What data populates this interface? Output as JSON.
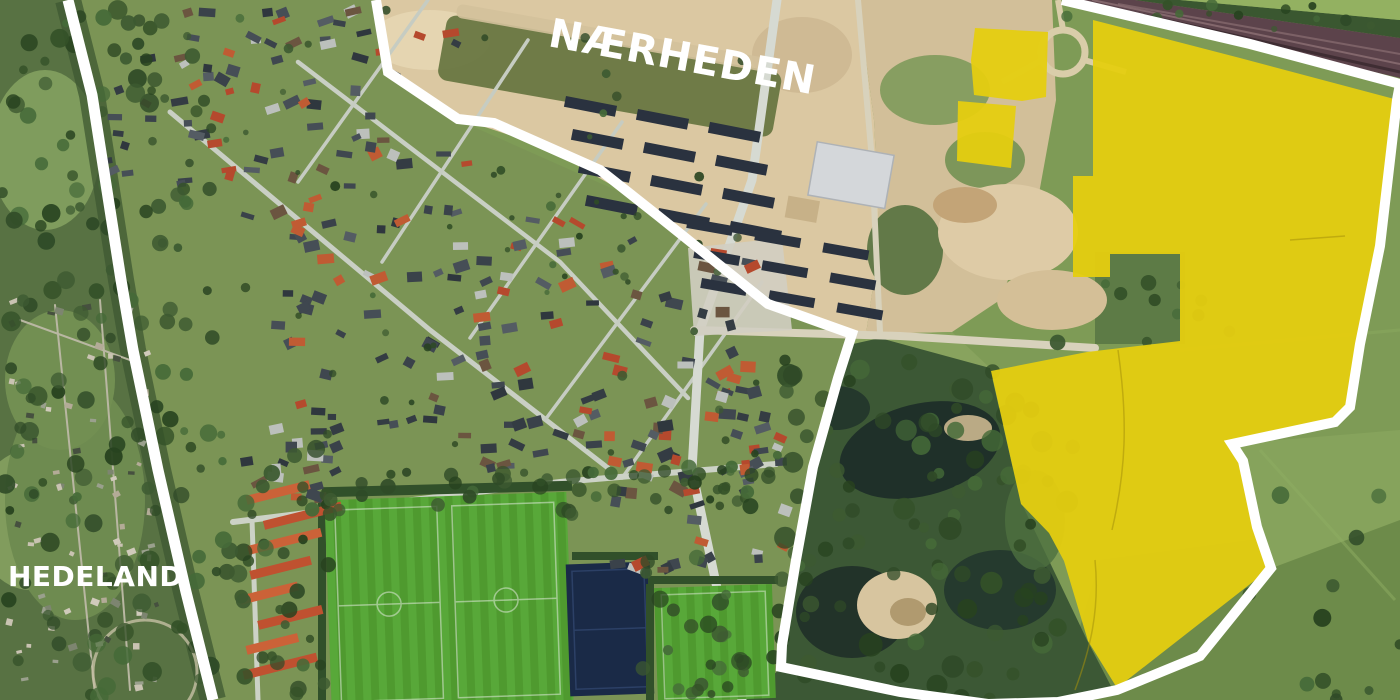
{
  "map": {
    "labels": {
      "naerheden": "NÆRHEDEN",
      "hedeland": "HEDELAND"
    },
    "overlay": {
      "highlight_color": "#e5ce10",
      "boundary_color": "#ffffff"
    }
  }
}
